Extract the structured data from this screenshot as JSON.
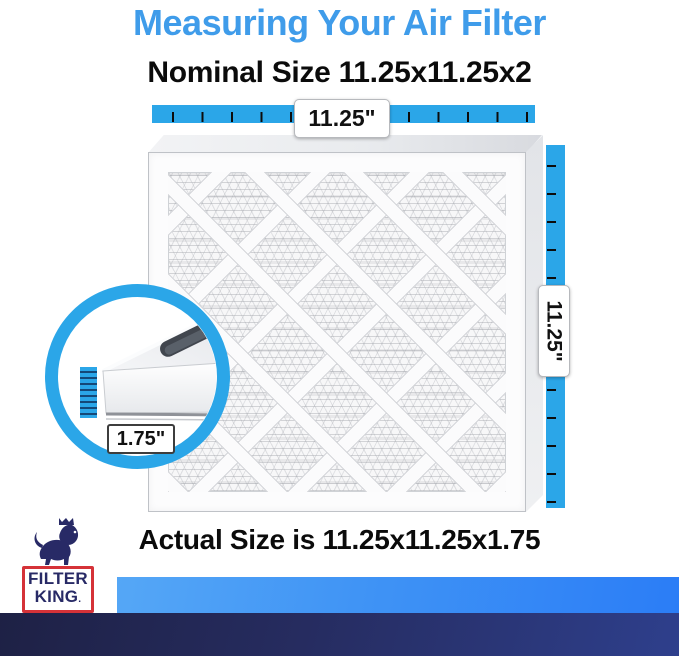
{
  "header": {
    "title": "Measuring Your Air Filter",
    "nominal": "Nominal Size 11.25x11.25x2",
    "actual": "Actual Size is 11.25x11.25x1.75"
  },
  "measurements": {
    "width": "11.25\"",
    "height": "11.25\"",
    "depth": "1.75\""
  },
  "logo": {
    "line1": "FILTER",
    "line2": "KING",
    "suffix": "."
  },
  "colors": {
    "title_blue": "#3f9cea",
    "ruler_blue": "#2ba6e8",
    "brand_navy": "#282a66",
    "brand_red": "#d53238",
    "footer_blue_start": "#55a7f6",
    "footer_blue_end": "#2b7df6",
    "footer_navy_start": "#1e2145",
    "footer_navy_end": "#2e3f8c"
  }
}
